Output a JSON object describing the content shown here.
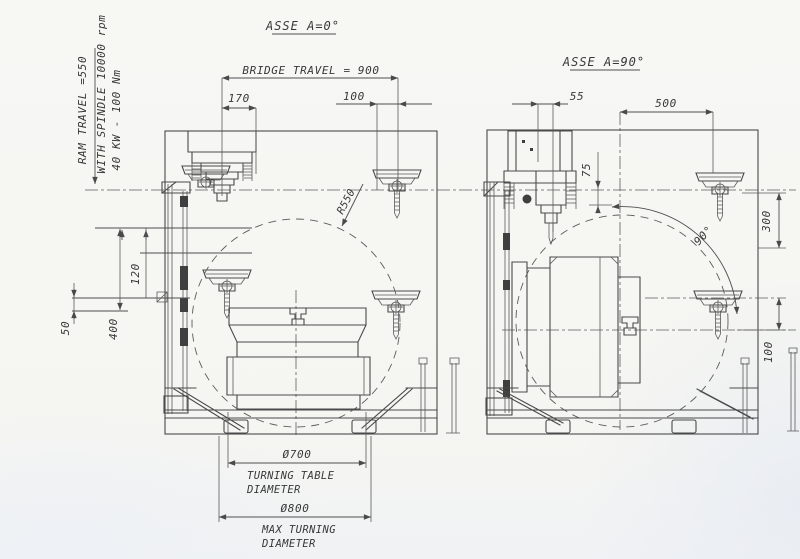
{
  "drawing": {
    "colors": {
      "paper": "#f6f6f3",
      "ink": "#4a4a4a",
      "shade": "#e9edf3"
    },
    "notes": {
      "ram_travel": "RAM TRAVEL =550",
      "spindle": "WITH SPINDLE 10000 rpm",
      "power": "40 KW - 100 Nm"
    },
    "left_view": {
      "title": "ASSE A=0°",
      "dims": {
        "bridge_travel": "BRIDGE TRAVEL = 900",
        "offset_left": "170",
        "offset_right": "100",
        "radius": "R550",
        "col_120": "120",
        "col_50": "50",
        "col_400": "400",
        "table_dia": "Ø700",
        "table_caption1": "TURNING TABLE",
        "table_caption2": "DIAMETER",
        "max_dia": "Ø800",
        "max_caption1": "MAX TURNING",
        "max_caption2": "DIAMETER"
      }
    },
    "right_view": {
      "title": "ASSE A=90°",
      "dims": {
        "offset_55": "55",
        "travel_500": "500",
        "offset_75": "75",
        "angle": "90°",
        "dist_300": "300",
        "dist_100": "100"
      }
    }
  }
}
